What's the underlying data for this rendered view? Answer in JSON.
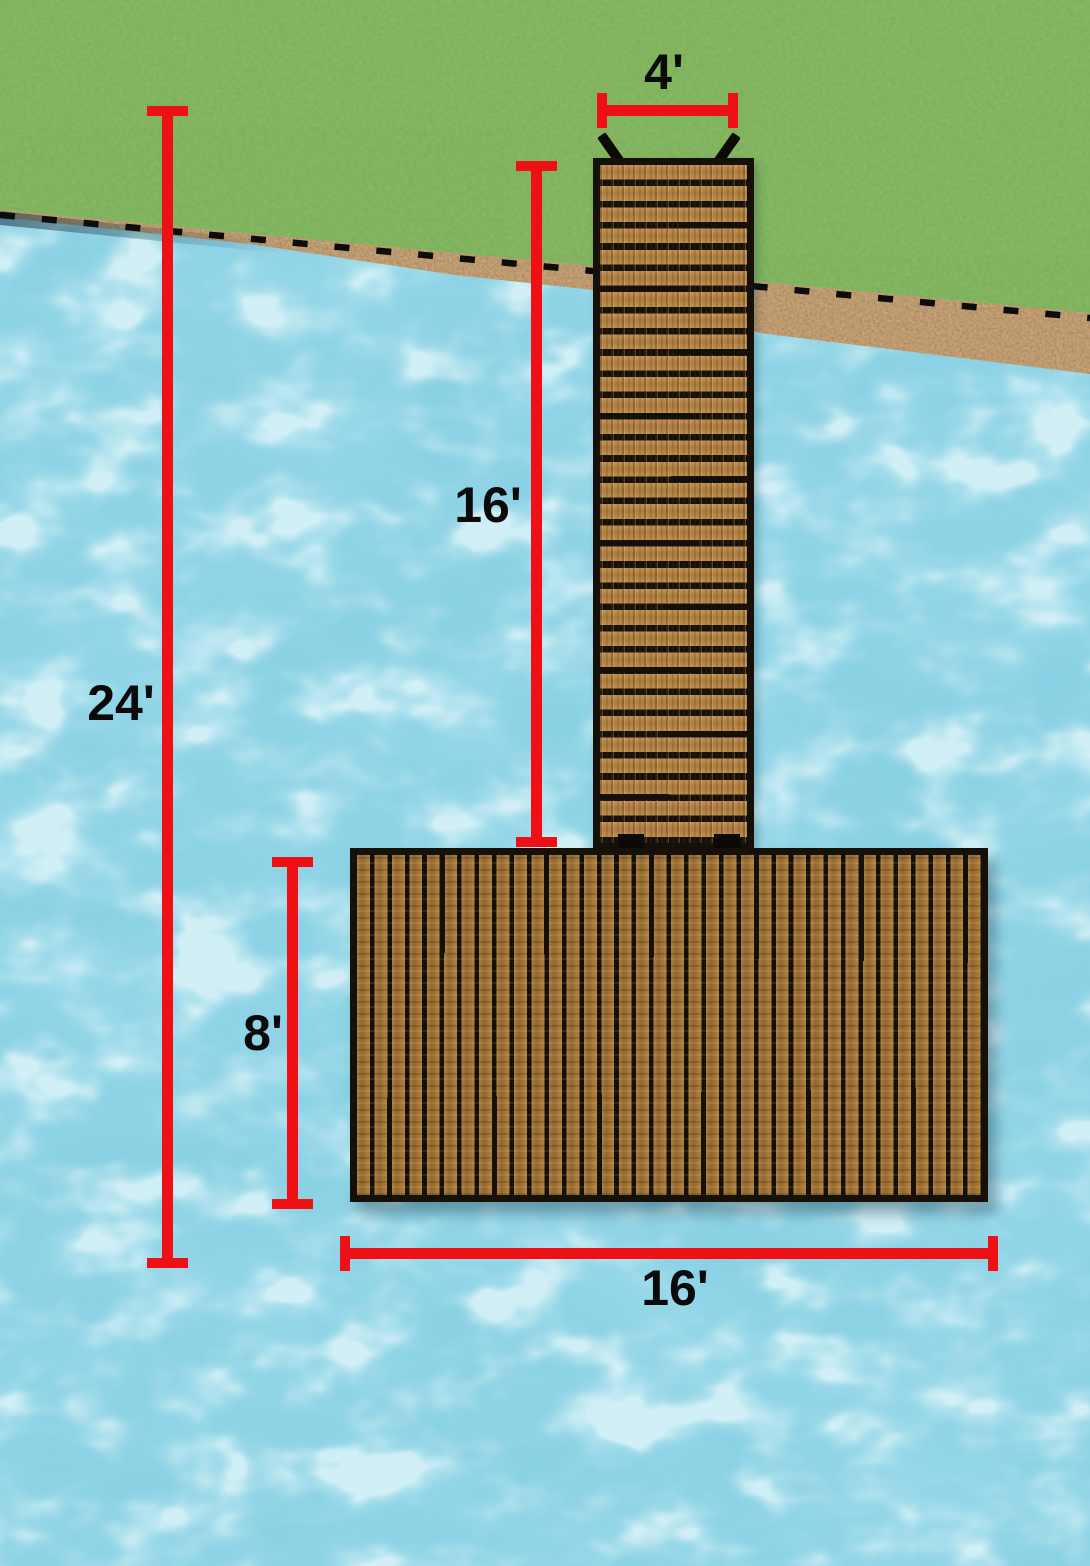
{
  "scene": {
    "title": "Dock dimension diagram",
    "description": "Top-down illustration of a T-shaped wooden dock running from a grassy shoreline across a sand strip into blue rippled water",
    "colors": {
      "dimension_red": "#ee1014",
      "label_text": "#0a0a0a",
      "grass": "#82b55f",
      "sand": "#c09a6f",
      "water": "#93d6e8",
      "walkway_wood": "#b98a48",
      "platform_wood": "#a2783c",
      "dock_outline": "#15100a"
    }
  },
  "dimensions": {
    "walkway_width": {
      "label": "4'",
      "orientation": "horizontal",
      "measures": "walkway width"
    },
    "walkway_length": {
      "label": "16'",
      "orientation": "vertical",
      "measures": "walkway length"
    },
    "total_length": {
      "label": "24'",
      "orientation": "vertical",
      "measures": "total dock length"
    },
    "platform_depth": {
      "label": "8'",
      "orientation": "vertical",
      "measures": "platform depth"
    },
    "platform_width": {
      "label": "16'",
      "orientation": "horizontal",
      "measures": "platform width"
    }
  }
}
